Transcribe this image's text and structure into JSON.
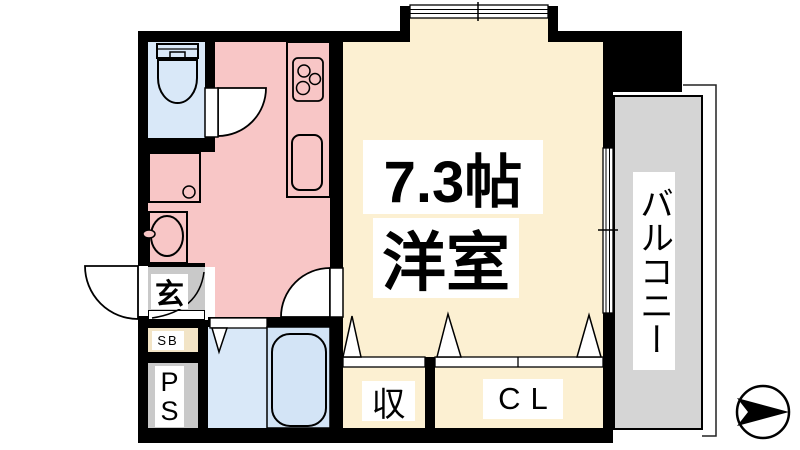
{
  "floor_plan": {
    "main_room": {
      "size_label": "7.3帖",
      "type_label": "洋室"
    },
    "balcony": {
      "label": "バルコニー"
    },
    "entrance": {
      "label": "玄"
    },
    "shoe_box": {
      "label": "SB"
    },
    "pipe_space": {
      "lines": [
        "P",
        "S"
      ]
    },
    "storage": {
      "label": "収"
    },
    "closet": {
      "label": "CL"
    }
  },
  "colors": {
    "wall": "#000000",
    "kitchen_hallway": "#f8c6c6",
    "western_room": "#fcf0d2",
    "bath_toilet": "#d9e8f8",
    "bathtub": "#d3e4f6",
    "balcony": "#d5d5d5",
    "entrance_floor": "#c9c9c9",
    "shoe_box": "#f2e4c6",
    "pipe_space": "#c9c9c9"
  },
  "icons": {
    "compass": "north-arrow-icon",
    "toilet": "toilet-icon",
    "stove": "stove-icon",
    "kitchen_sink": "kitchen-sink-icon",
    "washbasin": "washbasin-icon",
    "washer_drain": "drain-circle-icon",
    "bathtub": "bathtub-icon",
    "doors": "door-swing-icon"
  }
}
